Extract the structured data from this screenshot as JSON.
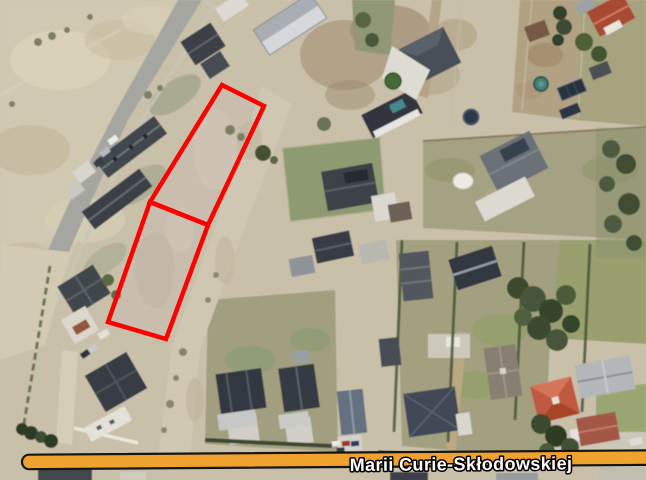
{
  "window": {
    "kind": "aerial-orthophoto-screenshot",
    "width_px": 646,
    "height_px": 480
  },
  "street_band": {
    "label": "Marii Curie-Skłodowskiej",
    "band_color": "#F0A22E",
    "border_color": "#151515",
    "label_color": "#FFFFFF",
    "label_outline_color": "#000000"
  },
  "parcel_overlay": {
    "outline_color": "#FF0000",
    "parcel_count": 2,
    "parcels": [
      {
        "id": "parcel-north",
        "points": "222,85 264,106 208,225 150,202"
      },
      {
        "id": "parcel-south",
        "points": "150,202 208,225 166,339 108,322"
      }
    ]
  },
  "photo": {
    "description": "aerial view of a suburban neighborhood: rows of dark-roofed houses, gardens, bare fields and an unpaved strip between plots",
    "base_color": "#C9C0AA"
  }
}
